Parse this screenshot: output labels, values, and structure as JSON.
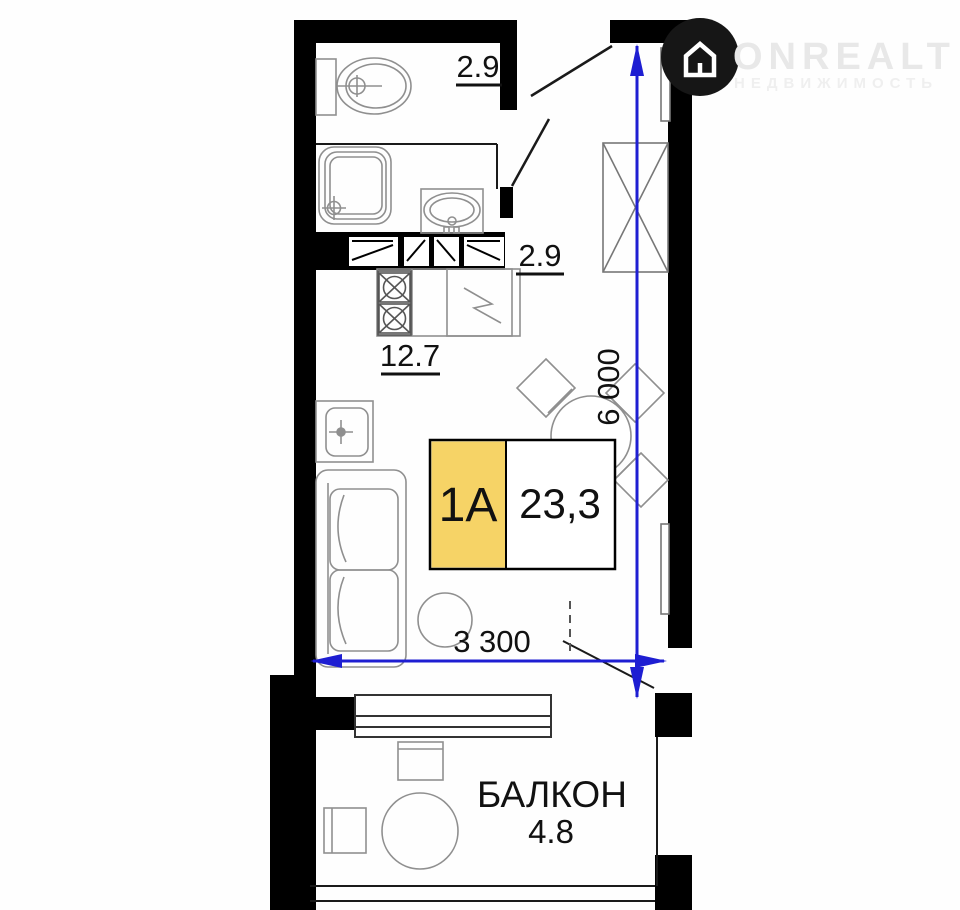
{
  "watermark": {
    "brand": "ONREALT",
    "tagline": "НЕДВИЖИМОСТЬ",
    "icon": "house-circle-icon"
  },
  "plan": {
    "unit_type": "1A",
    "total_area": "23,3",
    "balcony_label": "БАЛКОН",
    "areas": {
      "bathroom": "2.9",
      "hallway": "2.9",
      "living_kitchen": "12.7",
      "balcony": "4.8"
    },
    "dimensions": {
      "vertical": "6 000",
      "horizontal": "3 300"
    },
    "colors": {
      "dimension_blue": "#1e1ed2",
      "unit_highlight": "#f6d366",
      "walls": "#000000",
      "furniture_gray": "#8f8f8f"
    }
  }
}
